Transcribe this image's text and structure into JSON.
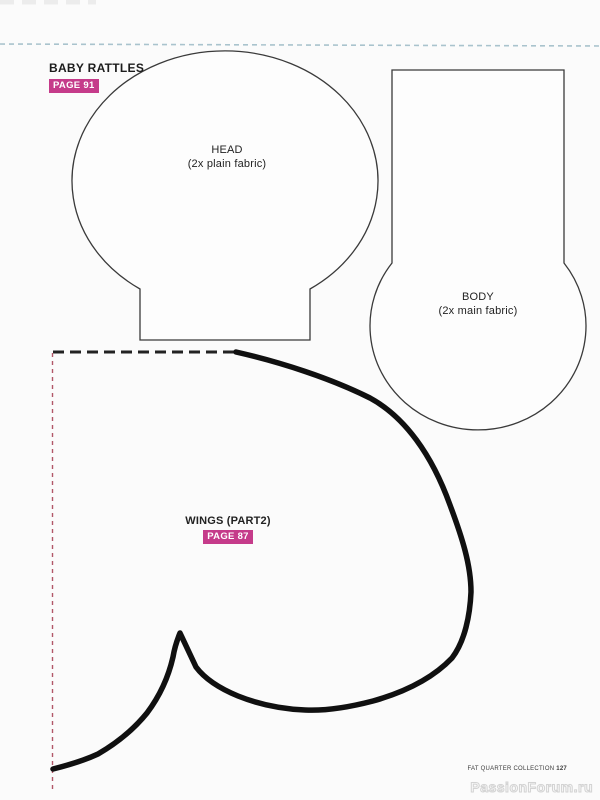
{
  "header": {
    "title": "BABY RATTLES",
    "badge": "PAGE 91"
  },
  "pieces": {
    "head": {
      "name": "HEAD",
      "note": "(2x plain fabric)"
    },
    "body": {
      "name": "BODY",
      "note": "(2x main fabric)"
    },
    "wings": {
      "name": "WINGS (PART2)",
      "badge": "PAGE 87"
    }
  },
  "footer": {
    "collection": "FAT QUARTER COLLECTION ",
    "page_number": "127"
  },
  "watermark": "PassionForum.ru",
  "colors": {
    "badge_pink": "#c53b8a",
    "cut_line_blue": "#a9c3cd",
    "edge_line_pink": "#b25768",
    "piece_outline": "#3a3a3a",
    "wing_stroke": "#101010",
    "background": "#fbfbfb"
  }
}
